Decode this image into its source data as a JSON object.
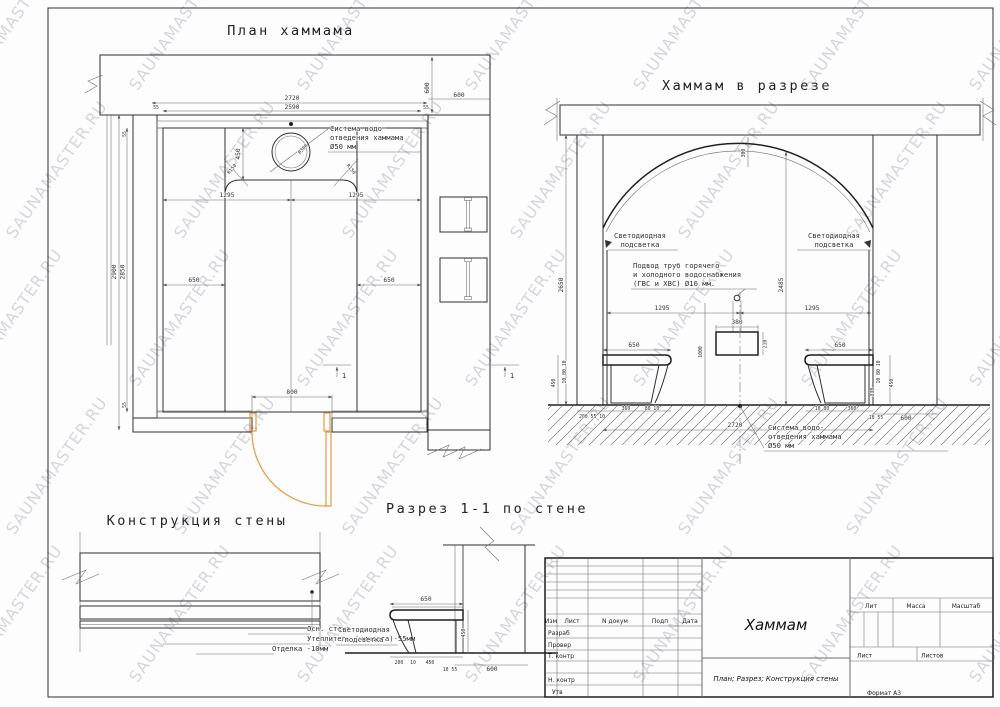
{
  "watermark": {
    "text": "SAUNAMASTER.RU"
  },
  "titles": {
    "plan": "План хаммама",
    "section": "Хаммам в разрезе",
    "wall_detail": "Конструкция стены",
    "wall_section": "Разрез 1-1 по стене"
  },
  "plan": {
    "dims": {
      "overall_width": "2720",
      "inner_width": "2590",
      "finish": "55",
      "top_wall_depth": "600",
      "right_wall_width": "600",
      "overall_height": "2900",
      "inner_height": "2850",
      "drain_offset": "450",
      "drain_circle": "Ø300",
      "corner_radius": "R150",
      "half_width": "1295",
      "bench_depth": "650",
      "door_width": "800"
    },
    "drain_note": {
      "l1": "Система водо-",
      "l2": "отведения хаммама",
      "l3": "Ø50 мм"
    },
    "cut_mark": "1"
  },
  "section": {
    "dims": {
      "arch_rise": "300",
      "room_height": "2650",
      "wall_clear_height": "2485",
      "half_width": "1295",
      "bench_width": "650",
      "bench_height": "450",
      "slab_layers": "10 80 10",
      "side_offset": "330",
      "stool_width": "380",
      "stool_height": "210",
      "pipe_height": "1000",
      "base_left": "200 55 10",
      "base_seat": "360",
      "base_edge": "80 10",
      "base_edge_r": "10 80",
      "base_corner": "10 55",
      "wall_width": "600",
      "overall_width": "2720"
    },
    "led_note": {
      "l1": "Светодиодная",
      "l2": "подсветка"
    },
    "pipe_note": {
      "l1": "Подвод труб горячего",
      "l2": "и холодного водоснабжения",
      "l3": "(ГВС и ХВС) Ø16 мм."
    },
    "drain_note": {
      "l1": "Система водо-",
      "l2": "отведения хаммама",
      "l3": "Ø50 мм"
    }
  },
  "wall_detail": {
    "layers": {
      "base": "Осн. стена",
      "insulation": "Утеплитель (минвата)-55мм",
      "finish": "Отделка -10мм"
    }
  },
  "wall_section": {
    "dims": {
      "bench_width": "650",
      "bench_height": "450",
      "d200": "200",
      "d10": "10",
      "d450": "450",
      "d10_55": "10 55",
      "d600": "600"
    }
  },
  "titleblock": {
    "cols": {
      "izm": "Изм",
      "list": "Лист",
      "ndoc": "N докум",
      "podp": "Подп",
      "data": "Дата"
    },
    "rows": {
      "razrab": "Разраб",
      "prover": "Провер",
      "tkontr": "Т. контр",
      "nkontr": "Н. контр",
      "utv": "Утв"
    },
    "title": "Хаммам",
    "subtitle": "План; Разрез; Конструкция стены",
    "right": {
      "lit": "Лит",
      "massa": "Масса",
      "scale": "Масштаб",
      "sheet": "Лист",
      "sheets": "Листов"
    },
    "format": "Формат А3"
  }
}
